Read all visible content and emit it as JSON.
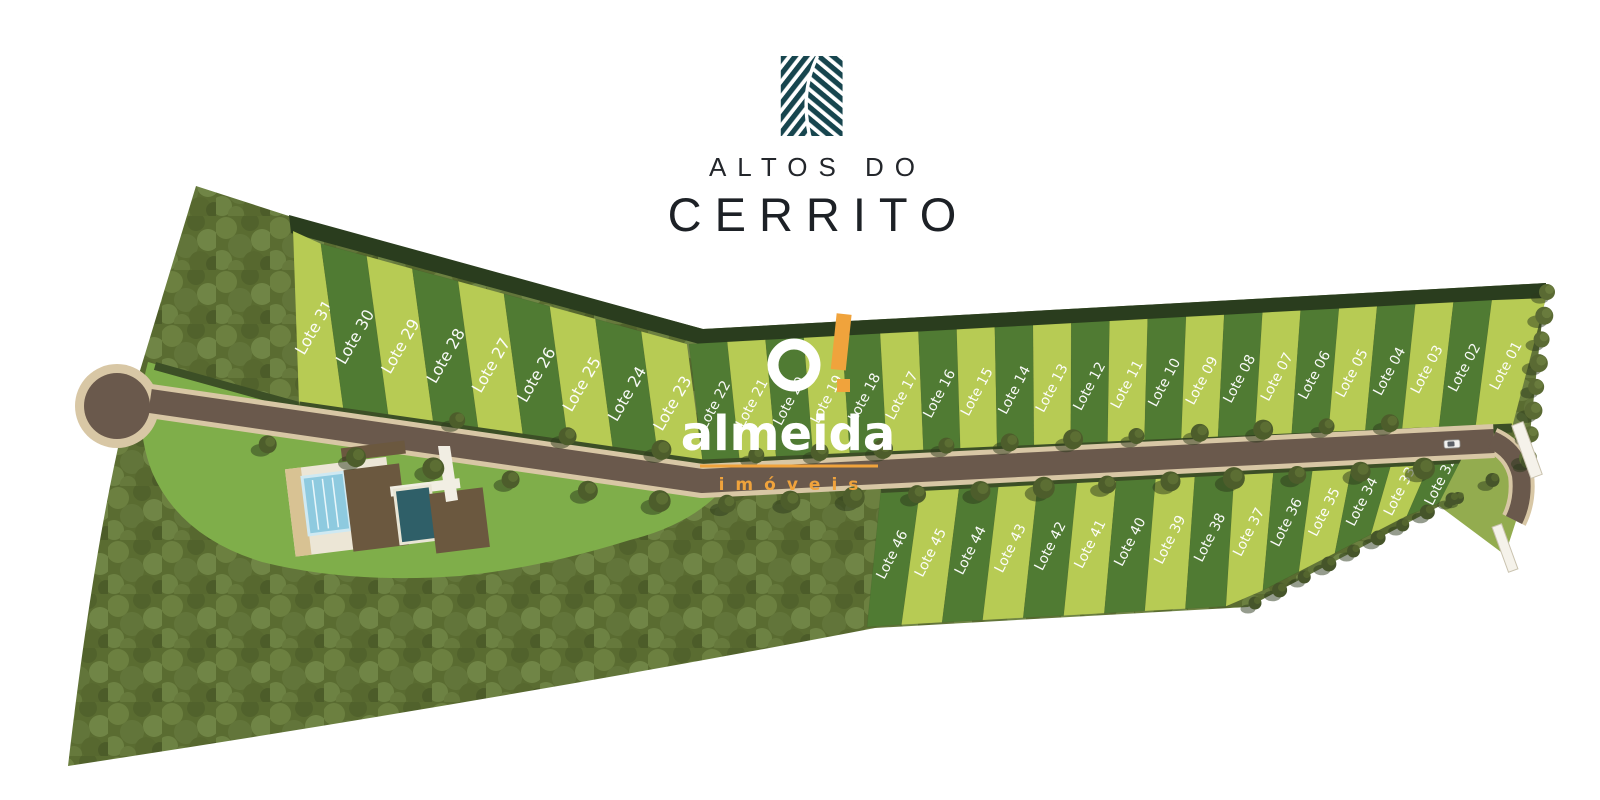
{
  "brand": {
    "line1": "ALTOS DO",
    "line2": "CERRITO",
    "logo_icon": "fern-leaf-icon",
    "logo_color": "#17454e",
    "text_color": "#1d2126"
  },
  "watermark": {
    "name": "almeida",
    "tagline": "imóveis",
    "accent": "#f0a33c",
    "text_color": "#ffffff"
  },
  "plan": {
    "lot_label_prefix": "Lote",
    "rows": {
      "top_left": [
        "31",
        "30",
        "29",
        "28",
        "27",
        "26",
        "25",
        "24",
        "23"
      ],
      "top_right": [
        "22",
        "21",
        "20",
        "19",
        "18",
        "17",
        "16",
        "15",
        "14",
        "13",
        "12",
        "11",
        "10",
        "09",
        "08",
        "07",
        "06",
        "05",
        "04",
        "03",
        "02",
        "01"
      ],
      "bottom": [
        "46",
        "45",
        "44",
        "43",
        "42",
        "41",
        "40",
        "39",
        "38",
        "37",
        "36",
        "35",
        "34",
        "33",
        "32"
      ]
    },
    "colors": {
      "lot_light": "#b7cb54",
      "lot_dark": "#507b33",
      "hedge": "#2a3d1e",
      "road_hedge": "#3c4f26",
      "lawn": "#7fae4a",
      "road": "#6a594c",
      "sidewalk": "#d8c7a5",
      "forest_base": "#5a6c31",
      "label": "#ffffff",
      "pool_light": "#8ecadf",
      "pool_dark": "#2f5f68",
      "deck": "#6b583f",
      "roof": "#ece6d6",
      "tree": "#4d5d2b",
      "gate": "#f5f2ea"
    }
  }
}
